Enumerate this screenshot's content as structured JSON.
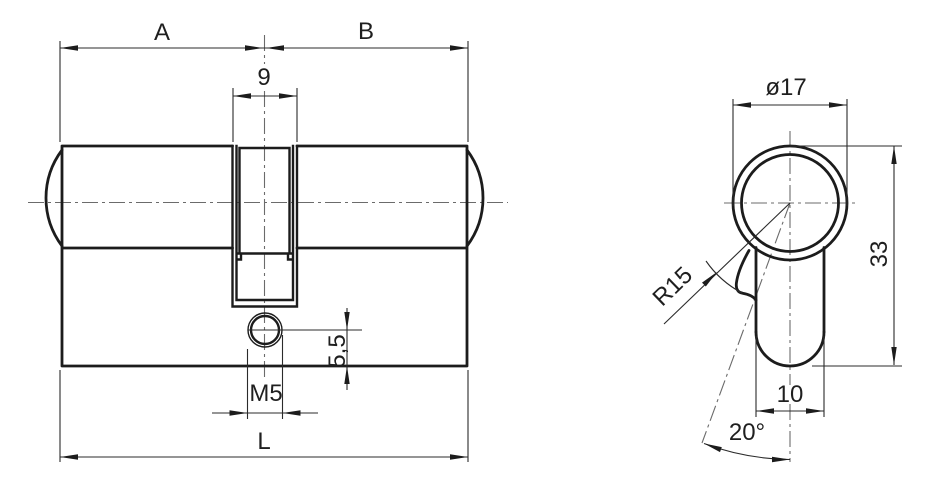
{
  "drawing": {
    "type": "technical-drawing",
    "subject": "double profile lock cylinder, front view and end profile view",
    "ink_color": "#1c1c1c",
    "centerline_color": "#6b6b6b",
    "background": "#ffffff"
  },
  "labels": {
    "front": {
      "a": "A",
      "b": "B",
      "slot_width": "9",
      "screw_thread": "M5",
      "screw_depth": "5,5",
      "total_length": "L"
    },
    "side": {
      "diameter": "ø17",
      "height": "33",
      "body_width": "10",
      "cam_radius": "R15",
      "cam_angle": "20°"
    }
  }
}
